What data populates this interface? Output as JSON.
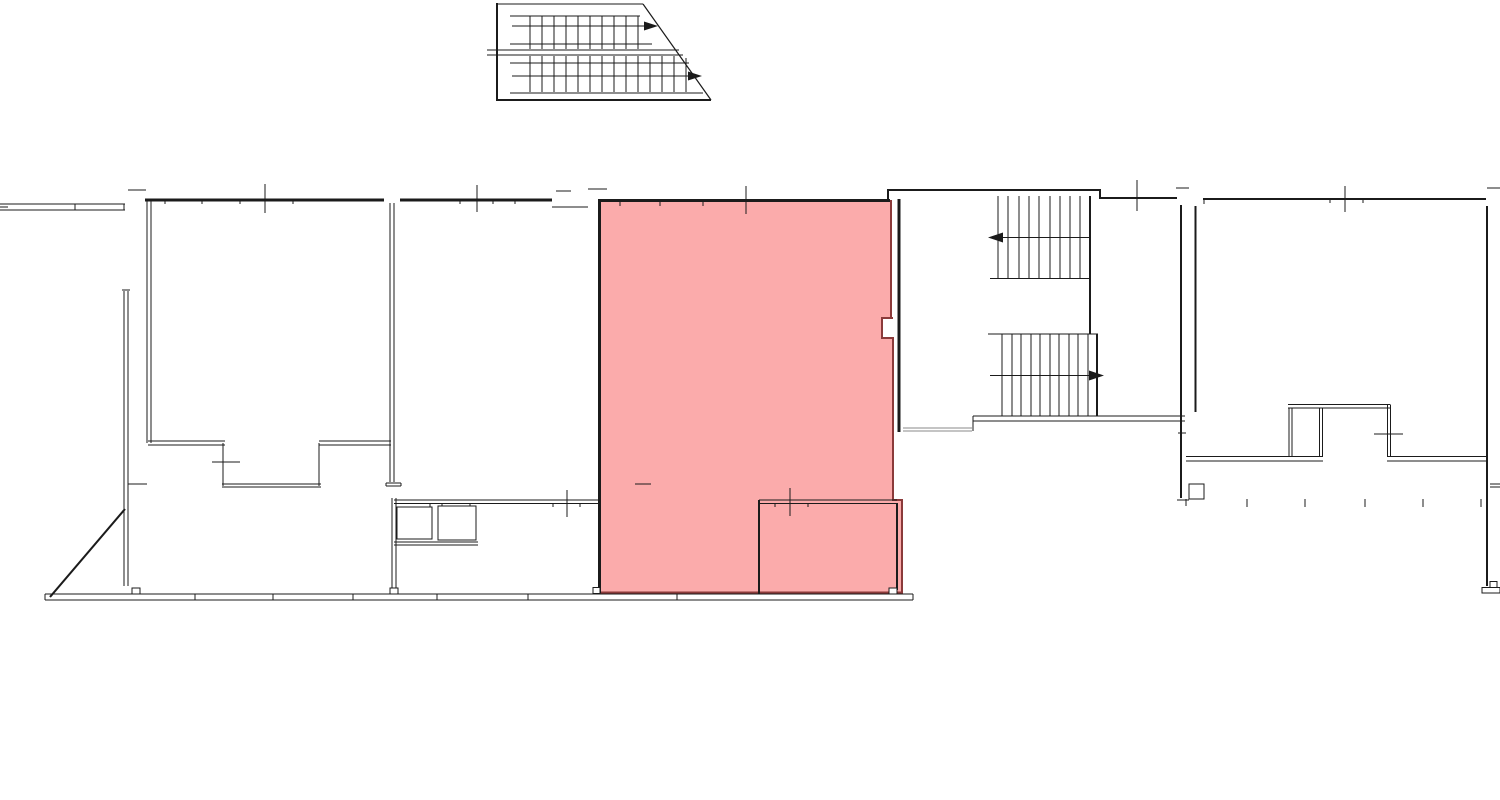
{
  "plan": {
    "kind": "architectural-floor-plan",
    "highlighted_room": {
      "selected": true,
      "fill": "#FBABAB",
      "outline": "#8B3A3A"
    }
  },
  "colors": {
    "background": "#FFFFFF",
    "line": "#1B1B1B",
    "gray_line": "#8A8A8A"
  }
}
